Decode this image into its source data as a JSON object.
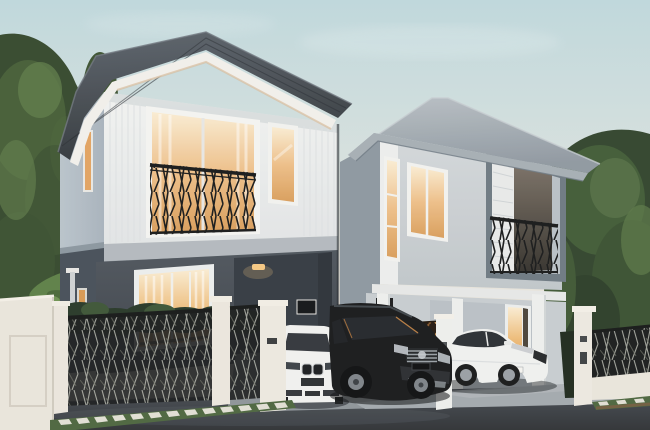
{
  "meta": {
    "width": 650,
    "height": 430,
    "kind": "architectural exterior rendering, dusk"
  },
  "scene": {
    "description": "Two modern two-storey detached houses at dusk with warm interior lighting, decorative branch-pattern fences, and three parked cars",
    "lighting": "dusk sky, warm orange interior window glow",
    "objects": {
      "sky": "pale dusk sky with soft clouds",
      "trees_left": "large green tree canopy on left edge",
      "tropical_plants": "tropical leaves behind left boundary wall",
      "trees_right": "dense green trees behind right fence",
      "house_left": {
        "roof": "dark slate hipped tile roof with white fascia",
        "upper_wall": "white vertical-siding facade",
        "balcony": "wide window with black branch-pattern juliet railing",
        "bedroom_window": "tall white-framed window, warm light",
        "ground_wall": "dark charcoal ground floor",
        "sliding_door": "glass sliding door with warm lit curtains",
        "porch": "recessed porch with ceiling light and wall art",
        "side_windows": "two narrow warm-lit slit windows on side wall",
        "downpipe": "white rain downpipe on side wall"
      },
      "house_right": {
        "roof": "light grey hipped tile roof",
        "upper_wall": "light grey facade with white corner trim",
        "tall_window": "tall warm-lit window",
        "double_window": "double warm-lit window",
        "balcony": "grey framed balcony box with shutter panel and black railing",
        "ground_wall": "light grey ground floor with white carport columns",
        "glass_door": "warm lit glass entry door",
        "wall_art": "small orange picture frame"
      },
      "boundary": {
        "left_wall": "tall cream rendered wall with recessed panel",
        "fence_panels": "black metal panels with light branch pattern",
        "pillars": "white masonry fence and gate pillars",
        "screen": "bronze decorative wavy screen panel",
        "shrubs": "dark green shrub row behind fence",
        "grass_verge": "green verge with white stepping stones",
        "right_fence": "black panel fence with white base and pillar"
      },
      "vehicles": {
        "white_suv": "white SUV, front view, twin kidney grille",
        "black_suv": "black SUV, three-quarter view, chrome grille",
        "white_sedan": "white sedan parked under right carport"
      },
      "ground": {
        "road": "dark asphalt street in foreground",
        "driveway_left": "grey concrete driveway of left house",
        "driveway_right": "light concrete driveway of right house"
      }
    }
  },
  "palette": {
    "sky_top": "#bfd9df",
    "sky_mid": "#dce3e1",
    "sky_horizon": "#eee6dd",
    "tree_dark": "#31452f",
    "tree_mid": "#415c39",
    "tree_light": "#5d7a4a",
    "roof_left_dark": "#33393f",
    "roof_left_light": "#5c646e",
    "fascia_white": "#f2f1ee",
    "wall_front_white": "#f2f4f4",
    "wall_side_blue": "#a8b4bf",
    "wall_charcoal": "#46505b",
    "porch_shadow": "#343b44",
    "slab_gray": "#b3bac1",
    "roof_right_light": "#b8c0c7",
    "roof_right_dark": "#8f99a3",
    "wall_right_light": "#d4d9dd",
    "wall_right_side": "#8d98a3",
    "wall_right_ground": "#c7ced3",
    "window_warm": "#eec08b",
    "window_deep": "#d99f5e",
    "window_bright": "#faeed6",
    "rail_black": "#17191c",
    "fence_white": "#ebe7df",
    "fence_panel_dark": "#191c1f",
    "fence_pattern_light": "#c9cdc4",
    "screen_bronze": "#cf9a5c",
    "screen_bg": "#241a12",
    "shrub_green": "#27392a",
    "grass_green": "#4c6741",
    "paver_white": "#e9e7e0",
    "road_dark": "#2f3338",
    "road_light": "#4c525b",
    "driveway_gray": "#8e959c",
    "driveway_light": "#a3aab0",
    "car_white": "#f1f2f2",
    "car_black": "#17191d",
    "glass_dark": "#2a2f36",
    "chrome_silver": "#9aa1a8"
  }
}
